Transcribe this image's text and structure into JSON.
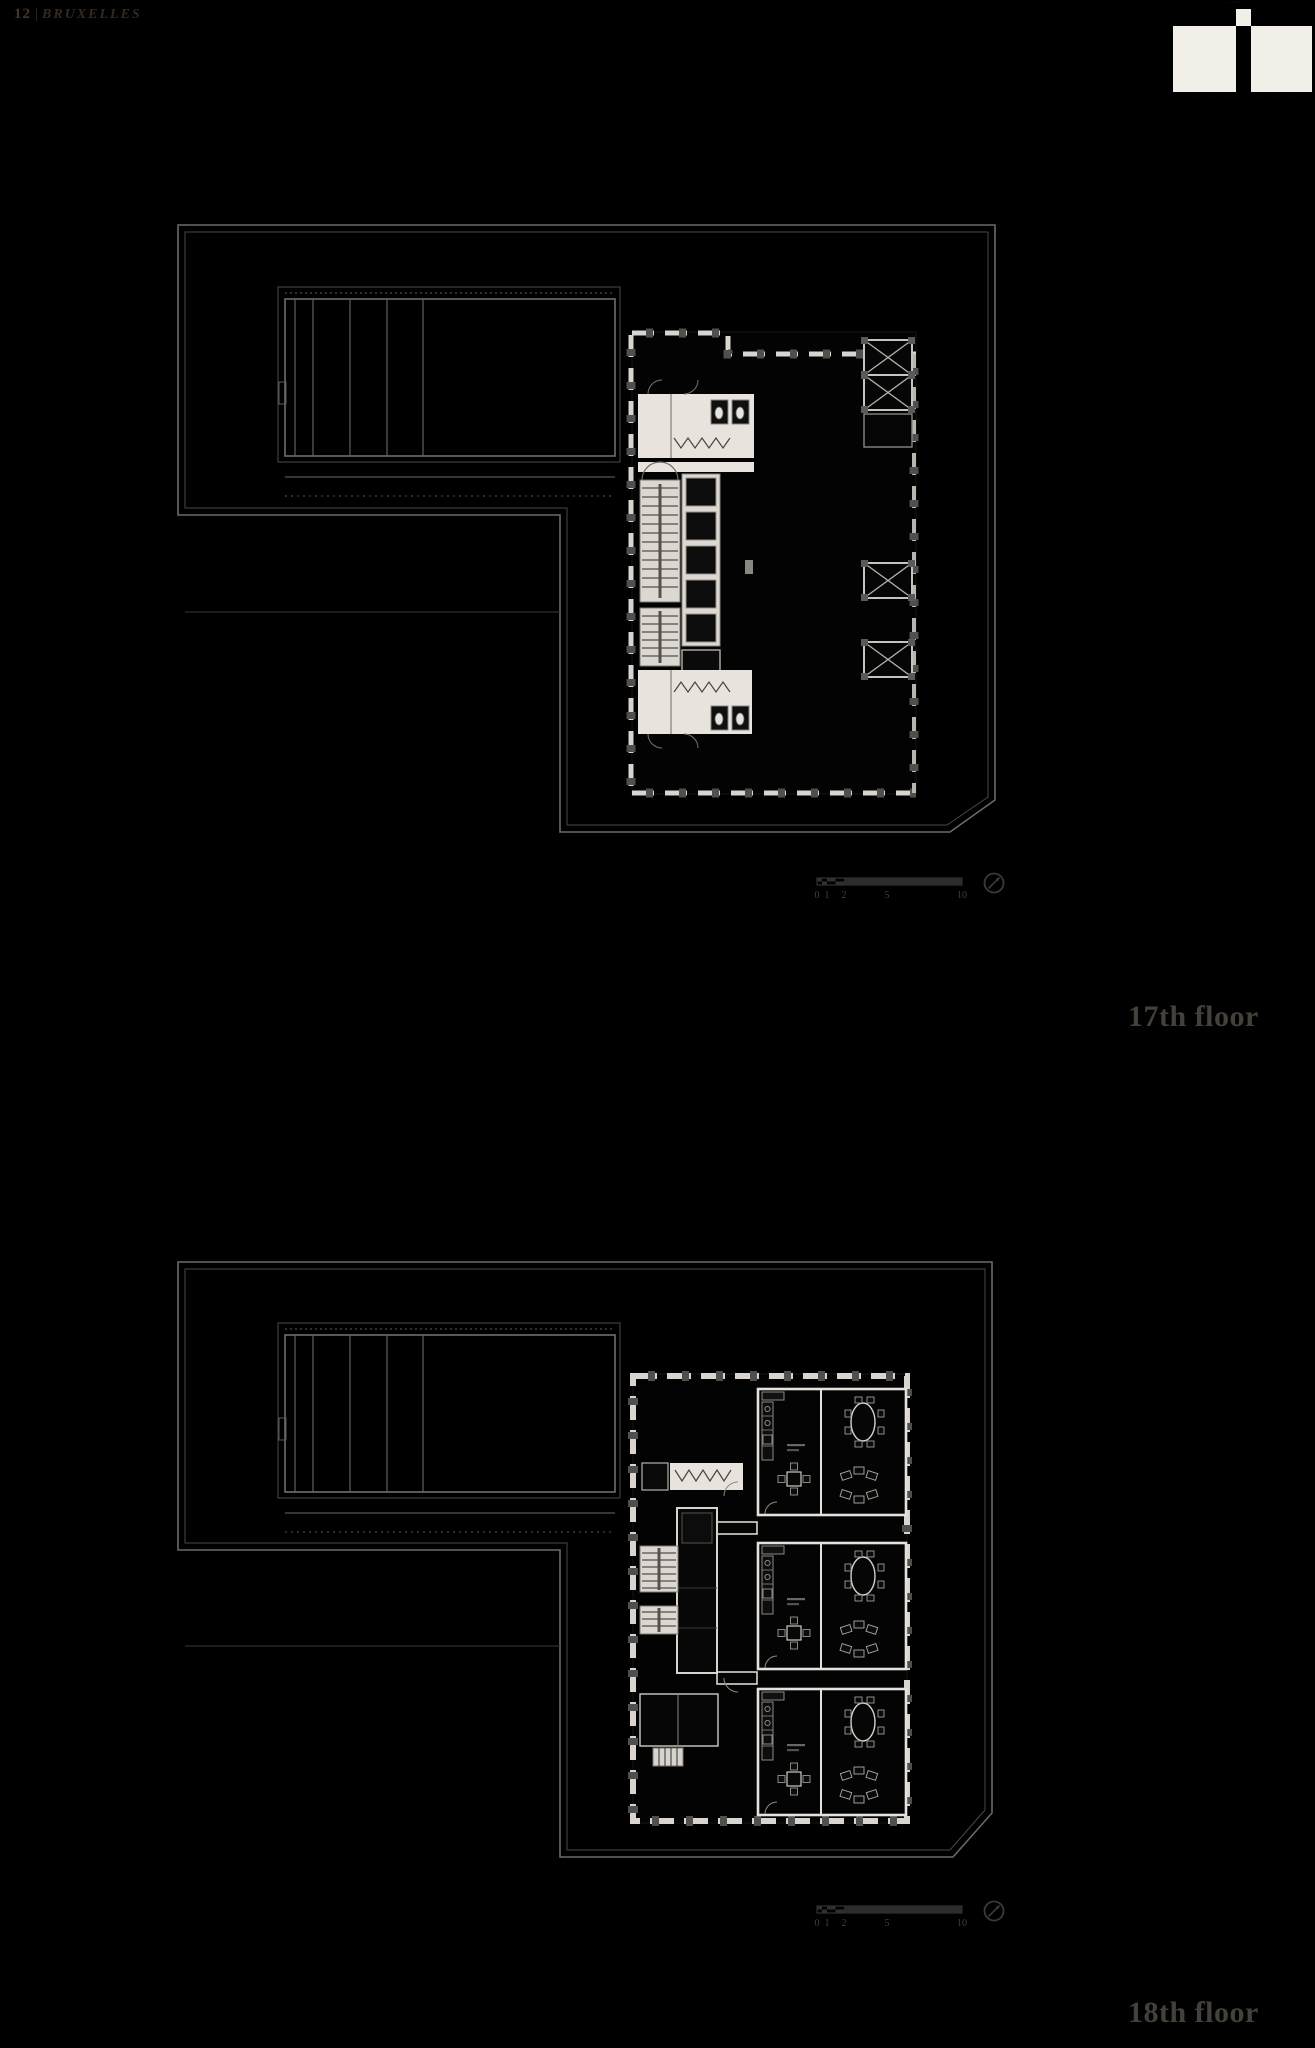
{
  "page": {
    "number": "12",
    "separator": "|",
    "title": "BRUXELLES"
  },
  "logo": {
    "top_text": "·····",
    "tagline": "·· ···· ······· ··· ········ ·· ···· ····· ······ ···"
  },
  "floors": [
    {
      "label": "17th floor"
    },
    {
      "label": "18th floor"
    }
  ],
  "scalebar": {
    "labels": [
      "0",
      "1",
      "2",
      "5",
      "10"
    ]
  },
  "colors": {
    "background": "#000000",
    "boundary_gray": "#6a6a6a",
    "wall_white": "#e8e4dd",
    "column_gray": "#4f4f4f",
    "floor_label_gray": "#44403a",
    "header_brown": "#352a20",
    "scalebar_gray": "#3a3a3a"
  }
}
